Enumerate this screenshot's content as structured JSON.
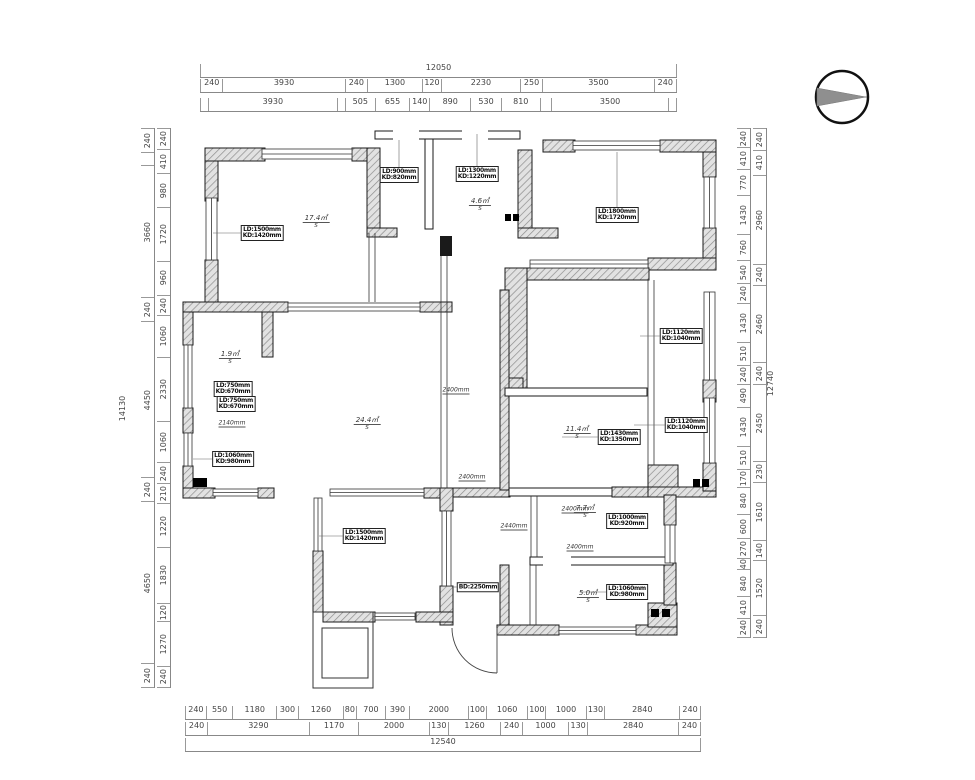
{
  "drawing": {
    "type_label": "floor plan",
    "north_arrow": "north-arrow"
  },
  "dimensions": {
    "top": {
      "total": [
        {
          "v": 12050,
          "t": "12050"
        }
      ],
      "row1": [
        {
          "v": 240,
          "t": "240"
        },
        {
          "v": 3930,
          "t": "3930"
        },
        {
          "v": 240,
          "t": "240"
        },
        {
          "v": 1300,
          "t": "1300"
        },
        {
          "v": 120,
          "t": "120"
        },
        {
          "v": 2230,
          "t": "2230"
        },
        {
          "v": 250,
          "t": "250"
        },
        {
          "v": 3500,
          "t": "3500"
        },
        {
          "v": 240,
          "t": "240"
        }
      ],
      "row2": [
        {
          "v": 240,
          "t": ""
        },
        {
          "v": 3930,
          "t": "3930"
        },
        {
          "v": 240,
          "t": ""
        },
        {
          "v": 505,
          "t": "505"
        },
        {
          "v": 655,
          "t": "655"
        },
        {
          "v": 140,
          "t": "140"
        },
        {
          "v": 890,
          "t": "890"
        },
        {
          "v": 530,
          "t": "530"
        },
        {
          "v": 810,
          "t": "810"
        },
        {
          "v": 370,
          "t": ""
        },
        {
          "v": 3500,
          "t": "3500"
        },
        {
          "v": 240,
          "t": ""
        }
      ]
    },
    "bottom": {
      "row1": [
        {
          "v": 240,
          "t": "240"
        },
        {
          "v": 550,
          "t": "550"
        },
        {
          "v": 1180,
          "t": "1180"
        },
        {
          "v": 300,
          "t": "300"
        },
        {
          "v": 1260,
          "t": "1260"
        },
        {
          "v": 80,
          "t": "80"
        },
        {
          "v": 700,
          "t": "700"
        },
        {
          "v": 390,
          "t": "390"
        },
        {
          "v": 2000,
          "t": "2000"
        },
        {
          "v": 100,
          "t": "100"
        },
        {
          "v": 1060,
          "t": "1060"
        },
        {
          "v": 100,
          "t": "100"
        },
        {
          "v": 1000,
          "t": "1000"
        },
        {
          "v": 130,
          "t": "130"
        },
        {
          "v": 2840,
          "t": "2840"
        },
        {
          "v": 240,
          "t": "240"
        }
      ],
      "row2": [
        {
          "v": 240,
          "t": "240"
        },
        {
          "v": 3290,
          "t": "3290"
        },
        {
          "v": 1170,
          "t": "1170"
        },
        {
          "v": 2000,
          "t": "2000"
        },
        {
          "v": 130,
          "t": "130"
        },
        {
          "v": 1260,
          "t": "1260"
        },
        {
          "v": 240,
          "t": "240"
        },
        {
          "v": 1000,
          "t": "1000"
        },
        {
          "v": 130,
          "t": "130"
        },
        {
          "v": 2840,
          "t": "2840"
        },
        {
          "v": 240,
          "t": "240"
        }
      ],
      "total": [
        {
          "v": 12540,
          "t": "12540"
        }
      ]
    },
    "left": {
      "total": "14130",
      "mid": [
        {
          "v": 240,
          "t": "240"
        },
        {
          "v": 410,
          "t": ""
        },
        {
          "v": 3660,
          "t": "3660"
        },
        {
          "v": 240,
          "t": "240"
        },
        {
          "v": 4450,
          "t": "4450"
        },
        {
          "v": 240,
          "t": "240"
        },
        {
          "v": 4650,
          "t": "4650"
        },
        {
          "v": 240,
          "t": "240"
        }
      ],
      "inner": [
        {
          "v": 240,
          "t": "240"
        },
        {
          "v": 410,
          "t": "410"
        },
        {
          "v": 980,
          "t": "980"
        },
        {
          "v": 1720,
          "t": "1720"
        },
        {
          "v": 960,
          "t": "960"
        },
        {
          "v": 240,
          "t": "240"
        },
        {
          "v": 1060,
          "t": "1060"
        },
        {
          "v": 2330,
          "t": "2330"
        },
        {
          "v": 1060,
          "t": "1060"
        },
        {
          "v": 240,
          "t": "240"
        },
        {
          "v": 210,
          "t": "210"
        },
        {
          "v": 1220,
          "t": "1220"
        },
        {
          "v": 1830,
          "t": "1830"
        },
        {
          "v": 120,
          "t": "120"
        },
        {
          "v": 1270,
          "t": "1270"
        },
        {
          "v": 240,
          "t": "240"
        }
      ]
    },
    "right": {
      "total": "12740",
      "inner": [
        {
          "v": 240,
          "t": "240"
        },
        {
          "v": 410,
          "t": "410"
        },
        {
          "v": 770,
          "t": "770"
        },
        {
          "v": 1430,
          "t": "1430"
        },
        {
          "v": 760,
          "t": "760"
        },
        {
          "v": 540,
          "t": "540"
        },
        {
          "v": 240,
          "t": "240"
        },
        {
          "v": 1430,
          "t": "1430"
        },
        {
          "v": 510,
          "t": "510"
        },
        {
          "v": 240,
          "t": "240"
        },
        {
          "v": 490,
          "t": "490"
        },
        {
          "v": 1430,
          "t": "1430"
        },
        {
          "v": 510,
          "t": "510"
        },
        {
          "v": 170,
          "t": "170"
        },
        {
          "v": 840,
          "t": "840"
        },
        {
          "v": 600,
          "t": "600"
        },
        {
          "v": 270,
          "t": "270"
        },
        {
          "v": 40,
          "t": "40"
        },
        {
          "v": 840,
          "t": "840"
        },
        {
          "v": 410,
          "t": "410"
        },
        {
          "v": 240,
          "t": "240"
        }
      ],
      "outer": [
        {
          "v": 240,
          "t": "240"
        },
        {
          "v": 410,
          "t": "410"
        },
        {
          "v": 2960,
          "t": "2960"
        },
        {
          "v": 240,
          "t": "240"
        },
        {
          "v": 2460,
          "t": "2460"
        },
        {
          "v": 240,
          "t": "240"
        },
        {
          "v": 2450,
          "t": "2450"
        },
        {
          "v": 230,
          "t": "230"
        },
        {
          "v": 1610,
          "t": "1610"
        },
        {
          "v": 140,
          "t": "140"
        },
        {
          "v": 1520,
          "t": "1520"
        },
        {
          "v": 240,
          "t": "240"
        }
      ]
    }
  },
  "plan": {
    "boxed_labels": [
      {
        "line1": "LD:1500mm",
        "line2": "KD:1420mm"
      },
      {
        "line1": "LD:900mm",
        "line2": "KD:820mm"
      },
      {
        "line1": "LD:1300mm",
        "line2": "KD:1220mm"
      },
      {
        "line1": "LD:1800mm",
        "line2": "KD:1720mm"
      },
      {
        "line1": "LD:750mm",
        "line2": "KD:670mm"
      },
      {
        "line1": "LD:750mm",
        "line2": "KD:670mm"
      },
      {
        "line1": "LD:1060mm",
        "line2": "KD:980mm"
      },
      {
        "line1": "LD:1430mm",
        "line2": "KD:1350mm"
      },
      {
        "line1": "LD:1120mm",
        "line2": "KD:1040mm"
      },
      {
        "line1": "LD:1120mm",
        "line2": "KD:1040mm"
      },
      {
        "line1": "LD:1500mm",
        "line2": "KD:1420mm"
      },
      {
        "line1": "LD:1000mm",
        "line2": "KD:920mm"
      },
      {
        "line1": "LD:1060mm",
        "line2": "KD:980mm"
      }
    ],
    "entry_label": "BD:2250mm",
    "area_labels": [
      "17.4㎡",
      "4.6㎡",
      "24.4㎡",
      "11.4㎡",
      "7.7㎡",
      "5.0㎡",
      "1.9㎡"
    ],
    "area_sub": "S",
    "wall_notes": [
      "2400mm",
      "2400mm",
      "2440mm",
      "2400mm",
      "2400mm",
      "2140mm"
    ]
  }
}
